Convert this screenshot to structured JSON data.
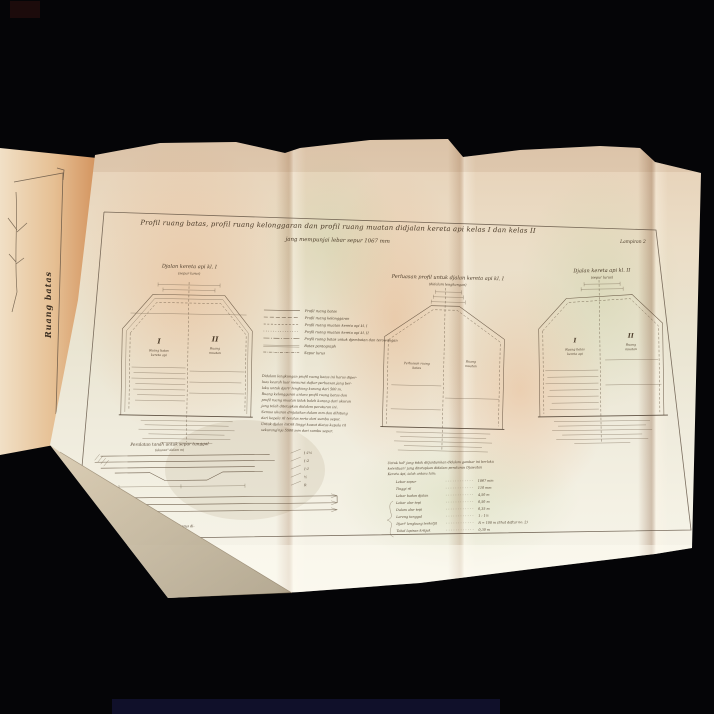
{
  "scene": {
    "background": "#050507",
    "paper_cream": "#eee9d8",
    "paper_warm": "#e8cdaf",
    "cover_orange": "#d89a66",
    "ink": "#4a3a28"
  },
  "left_page": {
    "vertical_label": "Ruang batas"
  },
  "sheet": {
    "corner_label": "Lampiran 2",
    "title_line1": "Profil ruang batas, profil ruang kelonggaran dan profil ruang muatan didjalan kereta api kelas I dan kelas II",
    "title_line2": "jang mempunjai lebar sepur 1067 mm"
  },
  "diagrams": {
    "left": {
      "title": "Djalan kereta api kl. I",
      "subtitle": "(sepur lurus)",
      "zone1": "I",
      "zone1_cap1": "Ruang batas",
      "zone1_cap2": "kereta api",
      "zone2": "II",
      "zone2_cap1": "Ruang",
      "zone2_cap2": "muatan"
    },
    "middle": {
      "title": "Perluasan profil untuk djalan kereta api kl. I",
      "subtitle": "(didalam lengkungan)",
      "zone1_cap1": "Perluasan ruang",
      "zone1_cap2": "batas",
      "zone2_cap1": "Ruang",
      "zone2_cap2": "muatan"
    },
    "right": {
      "title": "Djalan kereta api kl. II",
      "subtitle": "(sepur lurus)",
      "zone1": "I",
      "zone1_cap1": "Ruang batas",
      "zone1_cap2": "kereta api",
      "zone2": "II",
      "zone2_cap1": "Ruang",
      "zone2_cap2": "muatan"
    }
  },
  "legend": {
    "items": [
      "Profil ruang batas",
      "Profil ruang kelonggaran",
      "Profil ruang muatan kereta api kl. I",
      "Profil ruang muatan kereta api kl. II",
      "Profil ruang batas untuk djembatan dan terowongan",
      "Batas pantograph",
      "Sepur lurus"
    ]
  },
  "notes": {
    "lines": [
      "Didalam lengkungan profil ruang batas ini harus diper-",
      "luas kearah luar menurut daftar perluasan jang ber-",
      "laku untuk djari² lengkung kurang dari 500 m.",
      "Ruang kelonggaran antara profil ruang batas dan",
      "profil ruang muatan tidak boleh kurang dari ukuran",
      "jang telah ditetapkan didalam peraturan ini.",
      "Semua ukuran dinjatakan dalam mm dan dihitung",
      "dari kepala ril teratas serta dari sumbu sepur.",
      "Untuk djalan listrik tinggi kawat diatas kepala ril",
      "sekurang²nja 5500 mm dari sumbu sepur."
    ]
  },
  "earthworks": {
    "title": "Peralatan tanah untuk sepur tunggal",
    "subtitle": "(ukuran² dalam m)",
    "note_line1": "Untuk ril jang letaknja lebih tinggi, ukuran² ini harus di-",
    "note_line2": "tambah menurut keadaan setempat.",
    "slopes": [
      "1:1½",
      "1:2",
      "1:1",
      "½",
      "R"
    ]
  },
  "key": {
    "intro_line1": "Untuk hal² jang tidak ditjantumkan didalam gambar ini berlaku",
    "intro_line2": "ketentuan² jang ditetapkan didalam peraturan Djawatan",
    "intro_line3": "Kereta Api, ialah antara lain:",
    "rows": [
      {
        "label": "Lebar sepur",
        "value": "1067 mm"
      },
      {
        "label": "Tinggi ril",
        "value": "110 mm"
      },
      {
        "label": "Lebar badan djalan",
        "value": "4,50 m"
      },
      {
        "label": "Lebar alur tepi",
        "value": "0,50 m"
      },
      {
        "label": "Dalam alur tepi",
        "value": "0,35 m"
      },
      {
        "label": "Lereng tanggul",
        "value": "1 : 1½"
      },
      {
        "label": "Djari² lengkung terketjil",
        "value": "R = 100 m (lihat daftar no. 2)"
      },
      {
        "label": "Tebal lapisan kritjak",
        "value": "0,30 m"
      }
    ]
  }
}
